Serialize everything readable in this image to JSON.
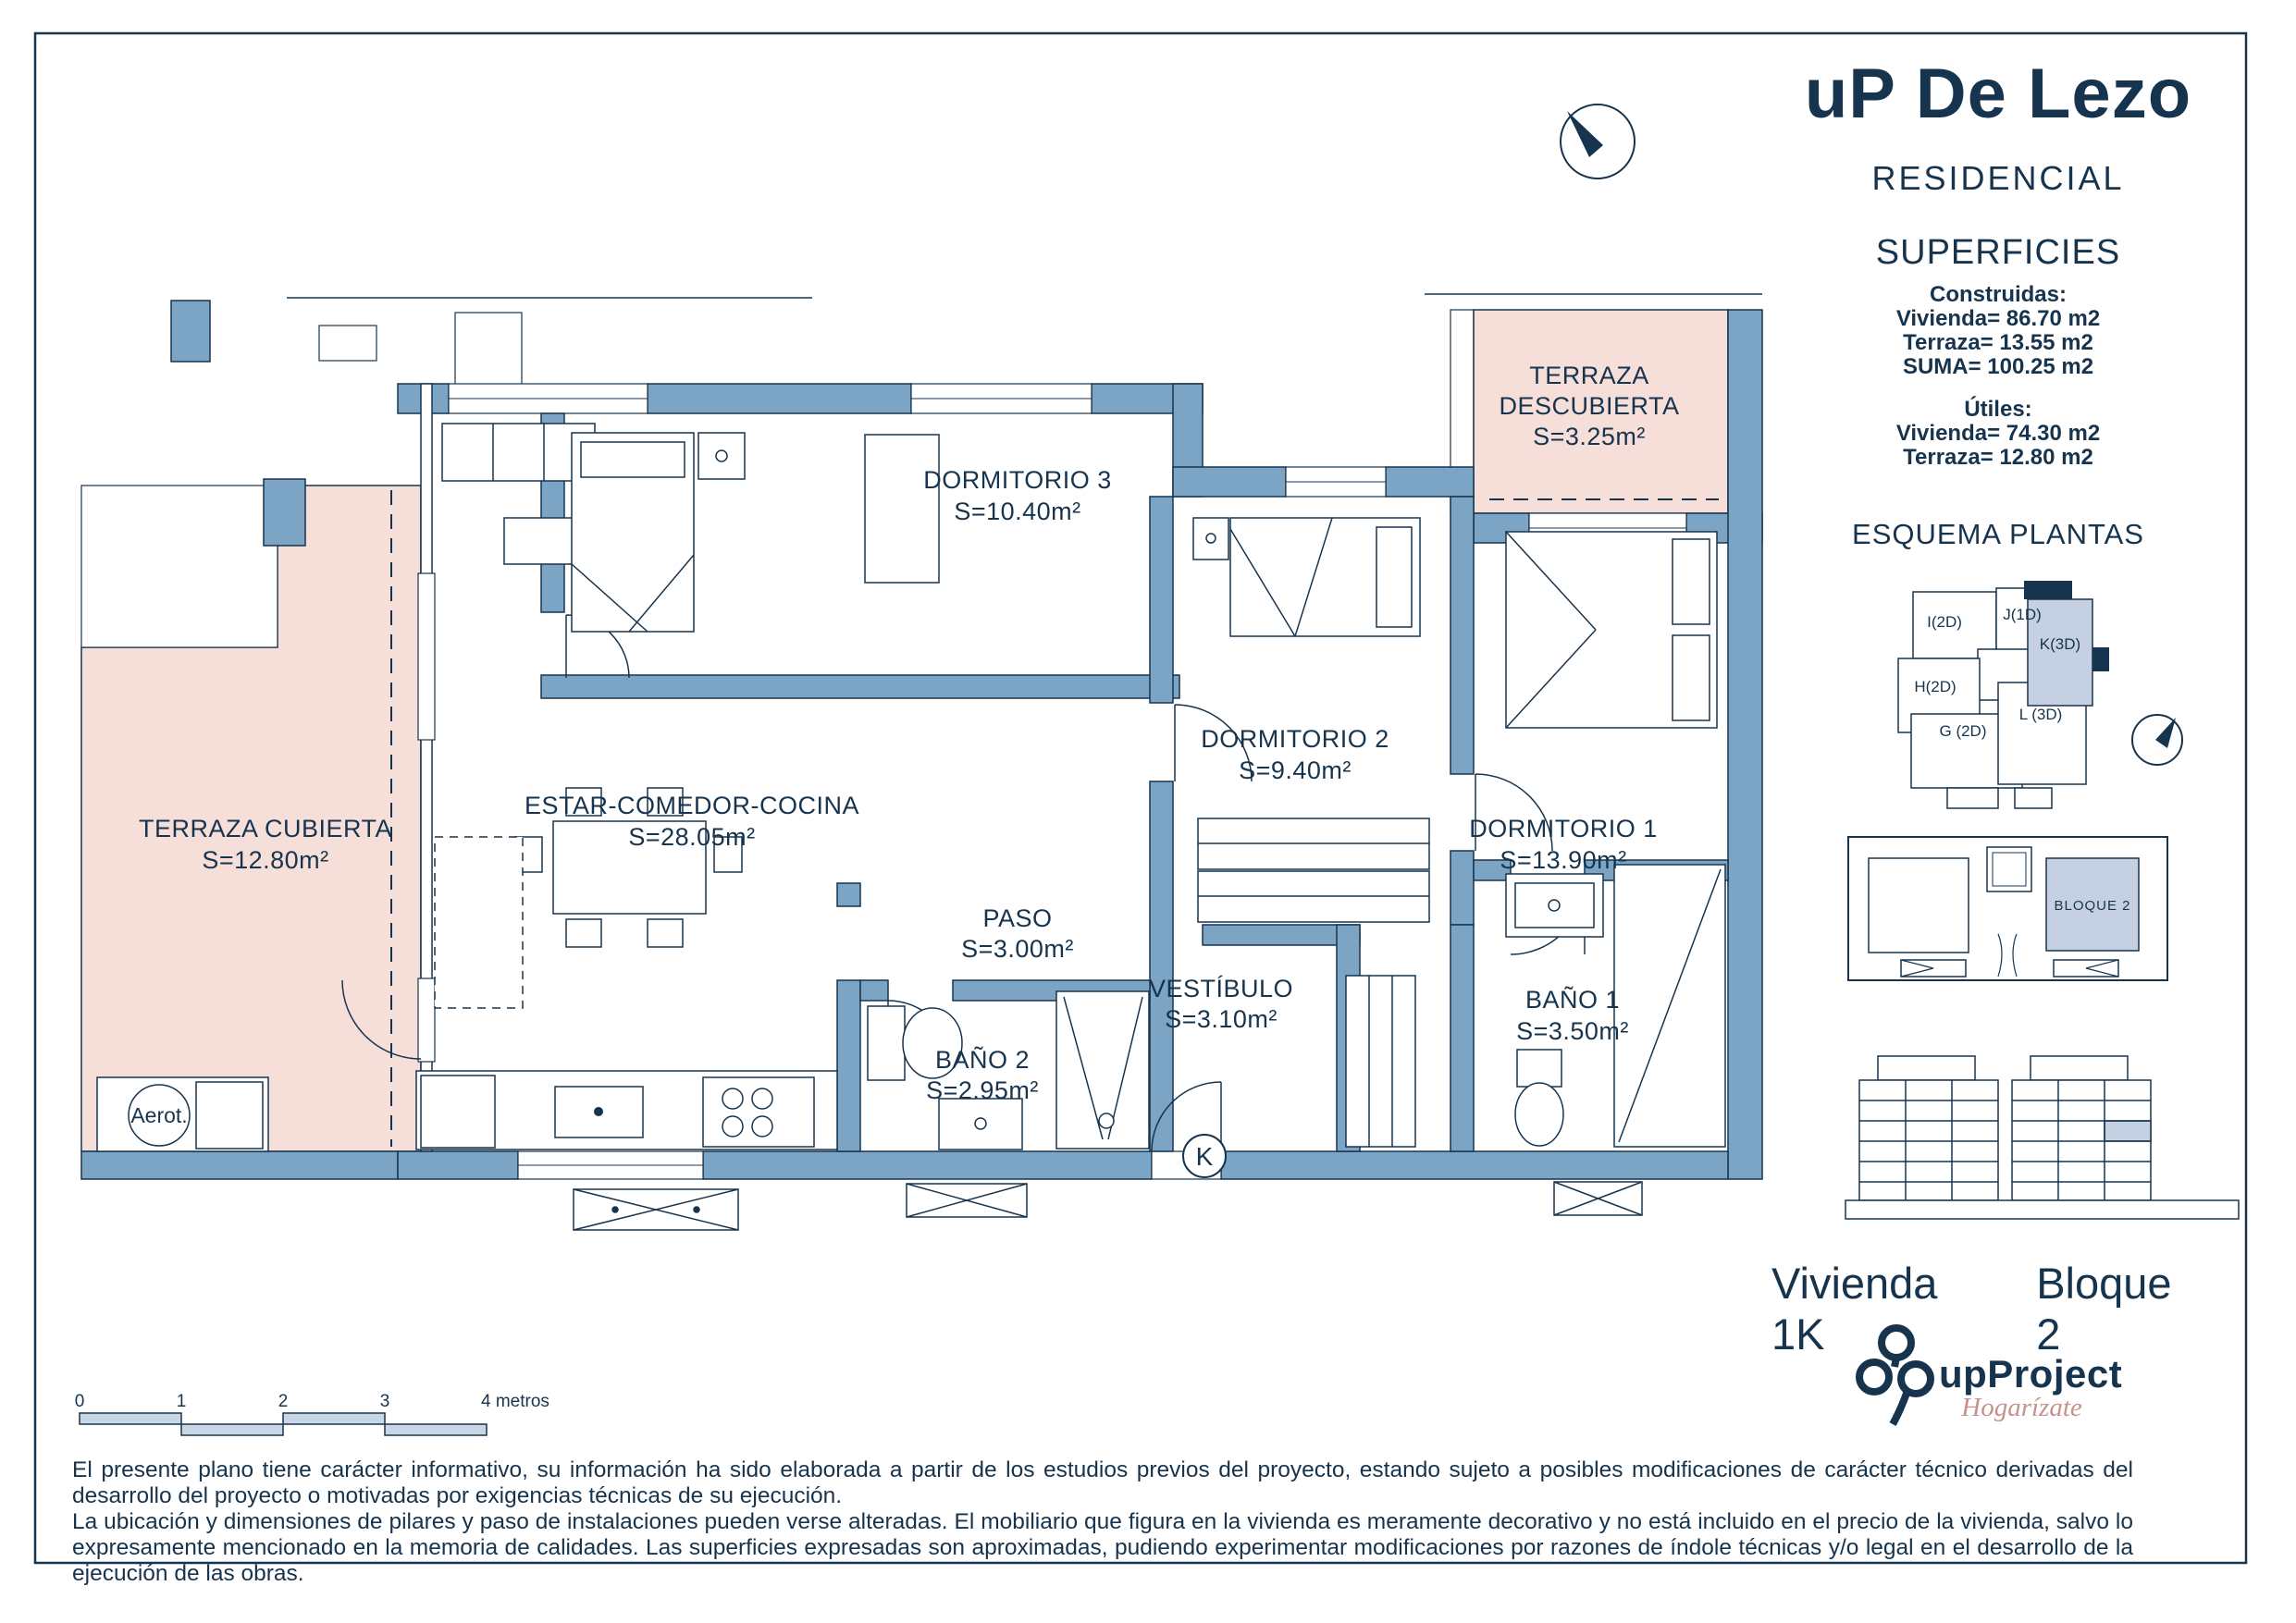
{
  "header": {
    "title": "uP De Lezo",
    "subtitle": "RESIDENCIAL",
    "north_icon": "compass-north-icon"
  },
  "superficies": {
    "heading": "SUPERFICIES",
    "construidas_label": "Construidas:",
    "construidas_lines": [
      "Vivienda=  86.70 m2",
      "Terraza=  13.55 m2",
      "SUMA=  100.25 m2"
    ],
    "utiles_label": "Útiles:",
    "utiles_lines": [
      "Vivienda=  74.30 m2",
      "Terraza=  12.80 m2"
    ]
  },
  "esquema": {
    "heading": "ESQUEMA PLANTAS",
    "units": [
      {
        "label": "I(2D)"
      },
      {
        "label": "J(1D)"
      },
      {
        "label": "K(3D)",
        "highlighted": true
      },
      {
        "label": "H(2D)"
      },
      {
        "label": "G (2D)"
      },
      {
        "label": "L (3D)"
      }
    ],
    "site": {
      "bloque_label": "BLOQUE 2"
    }
  },
  "plan": {
    "rooms": [
      {
        "name1": "TERRAZA",
        "name2": "DESCUBIERTA",
        "area": "S=3.25m²"
      },
      {
        "name": "DORMITORIO 3",
        "area": "S=10.40m²"
      },
      {
        "name": "DORMITORIO 2",
        "area": "S=9.40m²"
      },
      {
        "name": "DORMITORIO 1",
        "area": "S=13.90m²"
      },
      {
        "name": "ESTAR-COMEDOR-COCINA",
        "area": "S=28.05m²"
      },
      {
        "name": "TERRAZA CUBIERTA",
        "area": "S=12.80m²"
      },
      {
        "name": "PASO",
        "area": "S=3.00m²"
      },
      {
        "name": "VESTÍBULO",
        "area": "S=3.10m²"
      },
      {
        "name": "BAÑO 2",
        "area": "S=2.95m²"
      },
      {
        "name": "BAÑO 1",
        "area": "S=3.50m²"
      }
    ],
    "markers": {
      "aerot": "Aerot.",
      "unit_key": "K"
    }
  },
  "scalebar": {
    "labels": [
      "0",
      "1",
      "2",
      "3",
      "4 metros"
    ]
  },
  "footer": {
    "unit_label": "Vivienda 1K",
    "block_label": "Bloque 2",
    "brand": "upProject",
    "tagline": "Hogarízate",
    "disclaimer_p1": "El presente plano tiene carácter informativo, su información ha sido elaborada a partir de los estudios previos del proyecto, estando sujeto a posibles modificaciones de carácter técnico derivadas del desarrollo del proyecto o motivadas por exigencias técnicas de su ejecución.",
    "disclaimer_p2": "La ubicación y dimensiones de pilares y paso de instalaciones pueden verse alteradas. El mobiliario que figura en la vivienda es meramente decorativo y no está incluido en el precio de la vivienda, salvo lo expresamente mencionado en la memoria de calidades. Las superficies expresadas son aproximadas, pudiendo experimentar modificaciones por razones de índole técnicas y/o legal en el desarrollo de la ejecución de las obras."
  },
  "colors": {
    "navy": "#17344e",
    "wall_blue": "#7ba4c5",
    "terrace_pink": "#f6ded9",
    "highlight_blue": "#c5d0e2",
    "logo_pink": "#c9918b"
  }
}
